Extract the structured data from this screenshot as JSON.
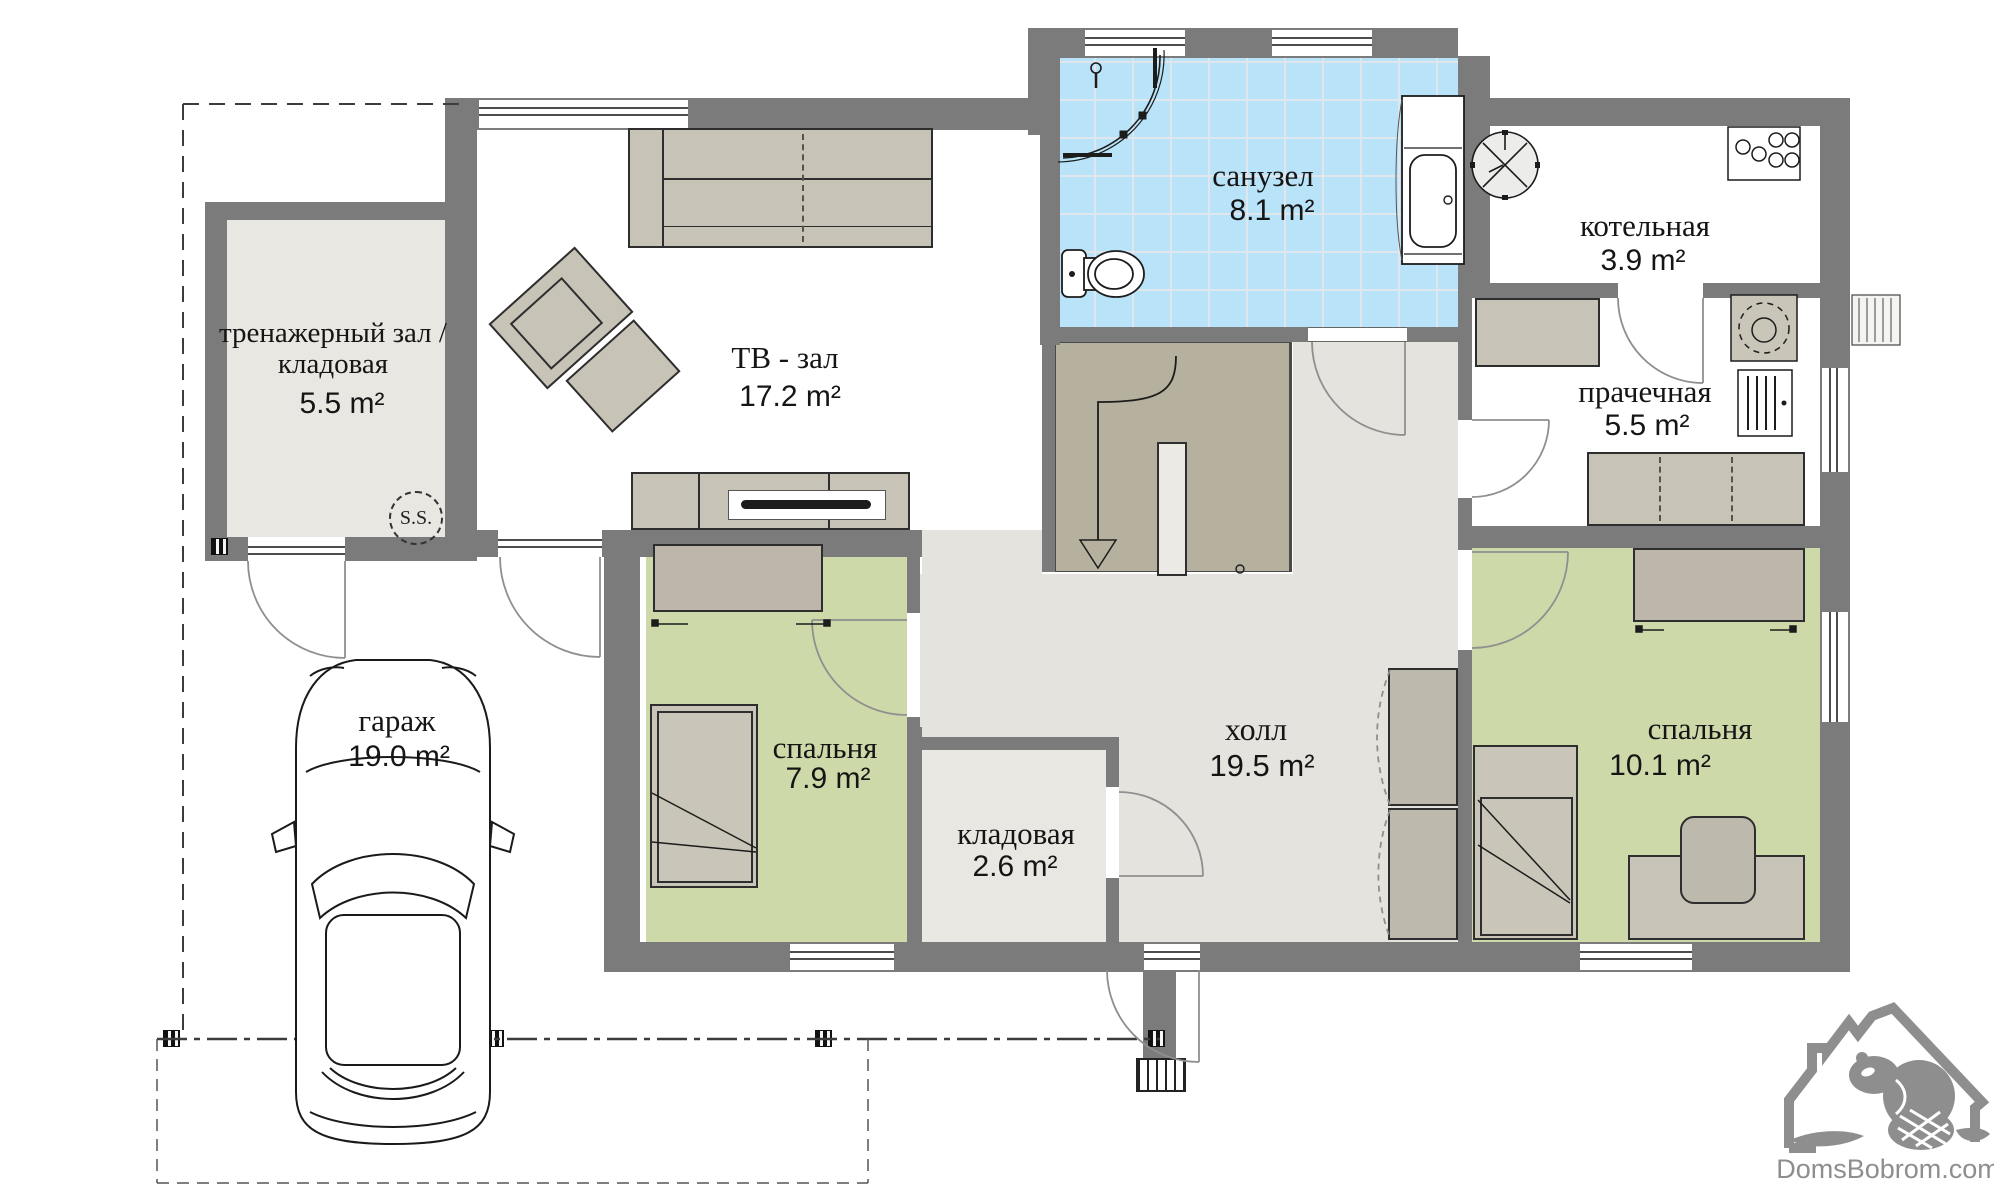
{
  "rooms": {
    "gym": {
      "name": "тренажерный зал / кладовая",
      "area": "5.5 m²"
    },
    "tv_room": {
      "name": "ТВ - зал",
      "area": "17.2 m²"
    },
    "bathroom": {
      "name": "санузел",
      "area": "8.1 m²"
    },
    "boiler_room": {
      "name": "котельная",
      "area": "3.9 m²"
    },
    "laundry": {
      "name": "прачечная",
      "area": "5.5 m²"
    },
    "bedroom_left": {
      "name": "спальня",
      "area": "7.9 m²"
    },
    "pantry": {
      "name": "кладовая",
      "area": "2.6 m²"
    },
    "hall": {
      "name": "холл",
      "area": "19.5 m²"
    },
    "bedroom_right": {
      "name": "спальня",
      "area": "10.1 m²"
    },
    "garage": {
      "name": "гараж",
      "area": "19.0 m²"
    }
  },
  "markers": {
    "sauna_stove": "S.S."
  },
  "watermark": {
    "site": "DomsBobrom.com"
  },
  "colors": {
    "wall": "#7b7b7b",
    "tile": "#b9e3f8",
    "bedroom": "#cdd9a9",
    "stairs": "#b6b09f",
    "logo": "#8e8e8e"
  }
}
